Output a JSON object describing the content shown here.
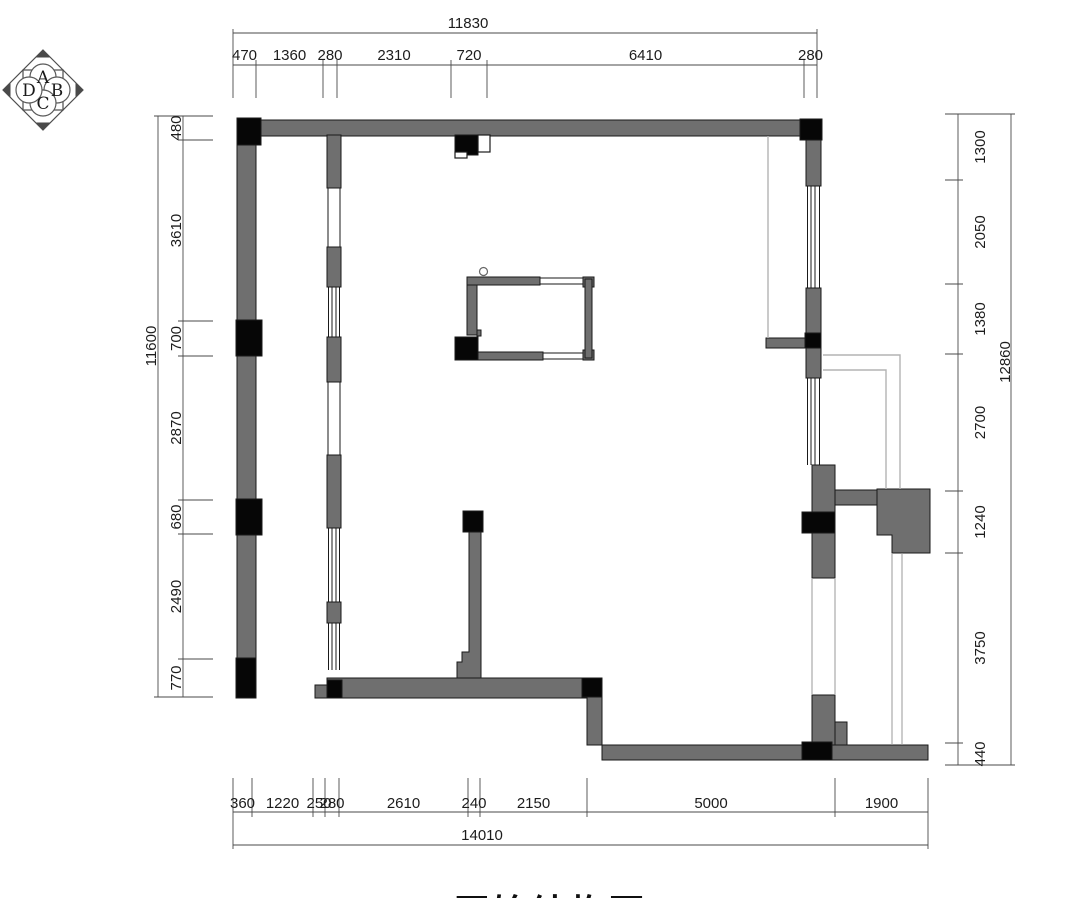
{
  "title": "原始结构图",
  "compass": {
    "letters": [
      "A",
      "B",
      "C",
      "D"
    ]
  },
  "dimensions": {
    "top": {
      "total": "11830",
      "segments": [
        "470",
        "1360",
        "280",
        "2310",
        "720",
        "6410",
        "280"
      ]
    },
    "bottom": {
      "total": "14010",
      "segments": [
        "360",
        "1220",
        "250",
        "280",
        "2610",
        "240",
        "2150",
        "5000",
        "1900"
      ]
    },
    "left": {
      "total": "11600",
      "segments": [
        "480",
        "3610",
        "700",
        "2870",
        "680",
        "2490",
        "770"
      ]
    },
    "right": {
      "total": "12860",
      "segments": [
        "1300",
        "2050",
        "1380",
        "2700",
        "1240",
        "3750",
        "440"
      ]
    }
  },
  "colors": {
    "wall": "#6f6f6f",
    "column": "#060606",
    "outline": "#1a1a1a",
    "dim": "#4a4a4a",
    "light": "#b3b3b3"
  }
}
